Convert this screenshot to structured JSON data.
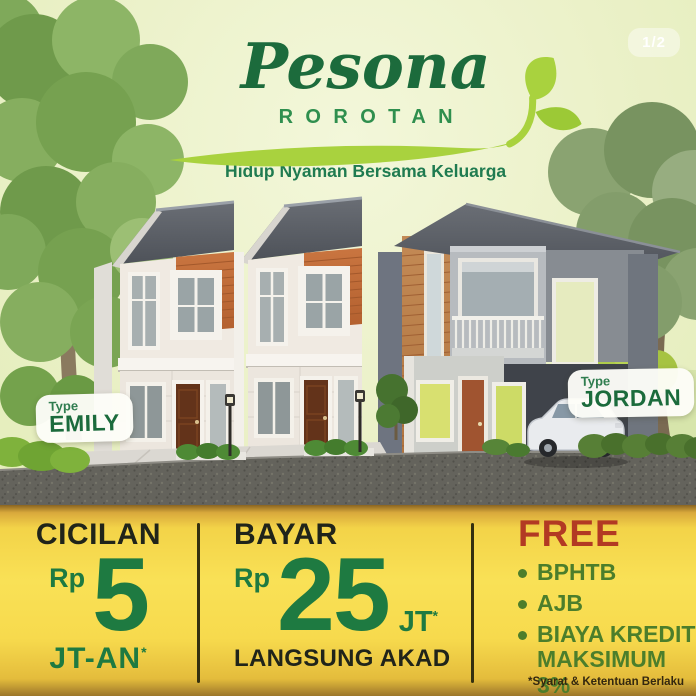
{
  "page": {
    "pagination": "1/2"
  },
  "header": {
    "brand": "Pesona",
    "brand_sub": "ROROTAN",
    "tagline": "Hidup Nyaman Bersama Keluarga"
  },
  "listings": {
    "left": {
      "label": "Type",
      "name": "EMILY"
    },
    "right": {
      "label": "Type",
      "name": "JORDAN"
    }
  },
  "pricing": {
    "installment": {
      "title": "CICILAN",
      "currency": "Rp",
      "amount": "5",
      "unit": "JT-AN",
      "note_mark": "*"
    },
    "payment": {
      "title": "BAYAR",
      "currency": "Rp",
      "amount": "25",
      "unit": "JT",
      "note_mark": "*",
      "subtitle": "LANGSUNG AKAD"
    },
    "free": {
      "title": "FREE",
      "items": [
        "BPHTB",
        "AJB",
        "BIAYA KREDIT MAKSIMUM 3%"
      ]
    },
    "terms": "*Syarat & Ketentuan Berlaku"
  },
  "colors": {
    "hero_bg": "#ebf1c8",
    "panel_yellow": "#f9e156",
    "brand_green": "#1c6b3c",
    "accent_green": "#2f8f4e",
    "leaf_green": "#a9d23e",
    "price_green": "#1e7a41",
    "dark_text": "#20241a",
    "free_red": "#b23a23",
    "bullet_green": "#4c7e2b"
  }
}
